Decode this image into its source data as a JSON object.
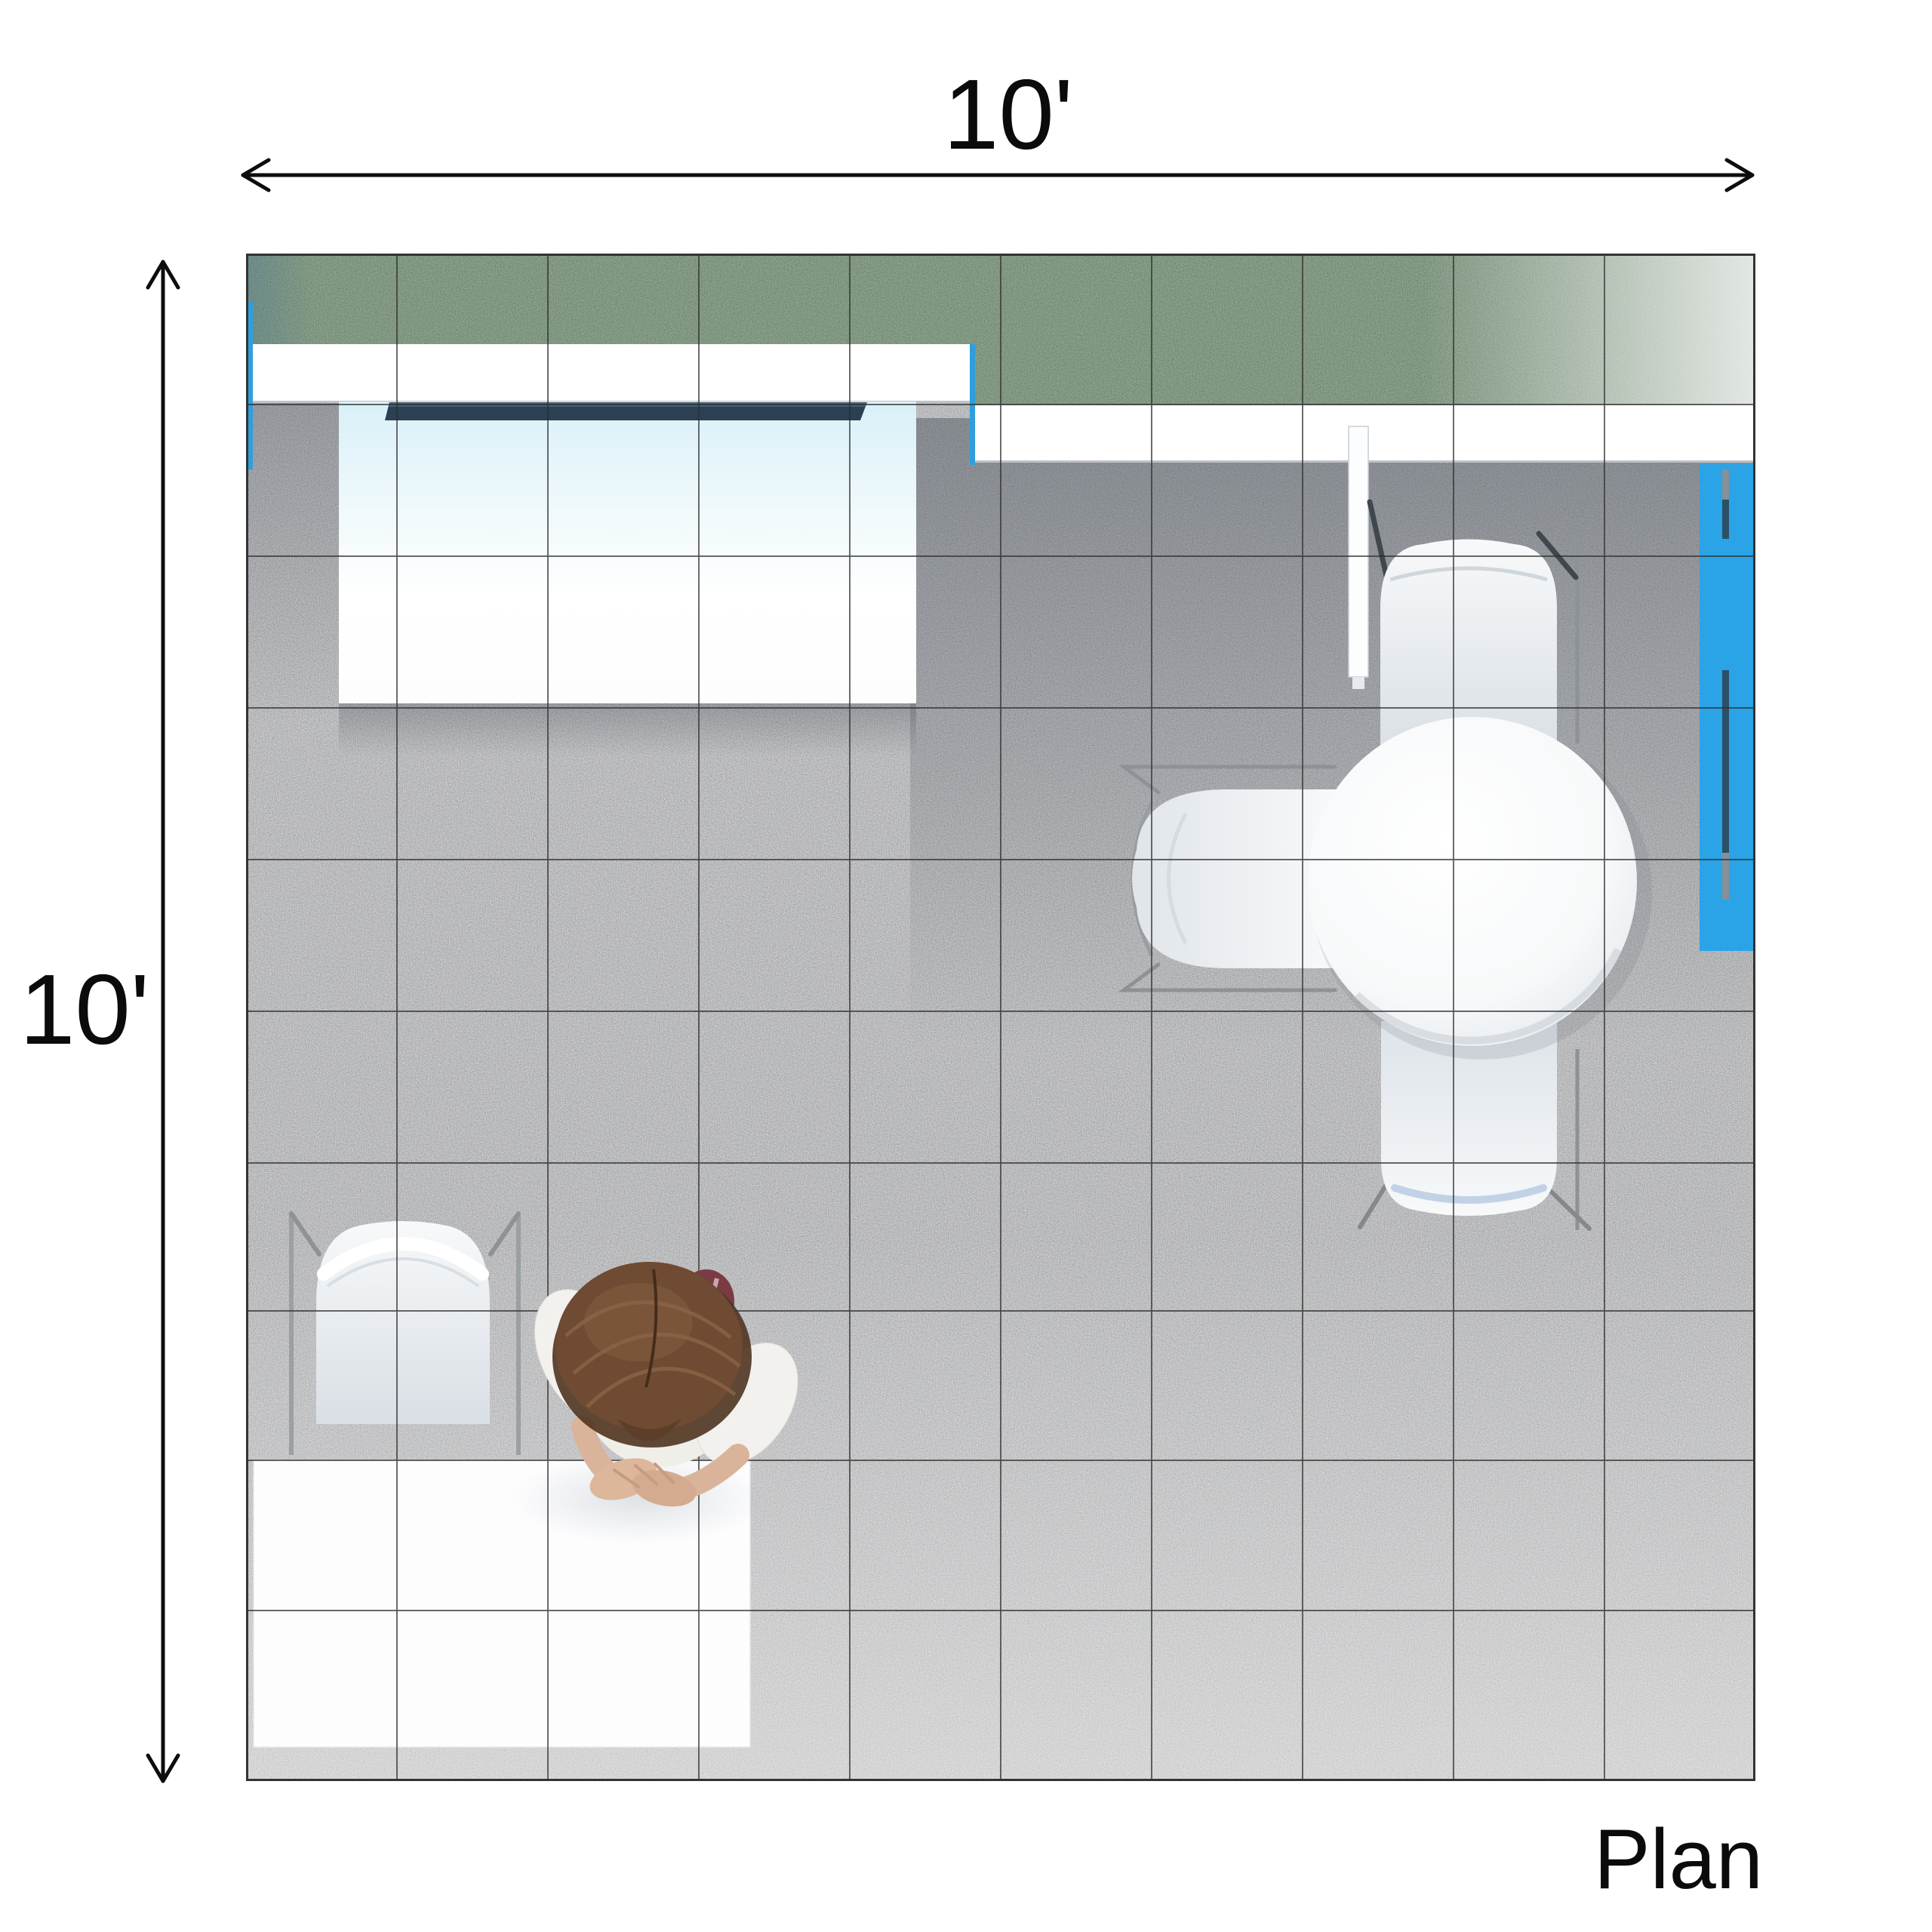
{
  "labels": {
    "width_dimension": "10'",
    "height_dimension": "10'",
    "caption": "Plan"
  },
  "scene": {
    "view": "top-down floor plan of 10 ft x 10 ft exhibit booth",
    "booth_width_label": "10'",
    "booth_depth_label": "10'",
    "grid": {
      "columns": 10,
      "rows": 10
    },
    "objects": [
      "green-carpet-band",
      "overhead-canopy-left",
      "overhead-canopy-right",
      "graphic-header-bar",
      "reception-counter",
      "blue-storage-cabinet",
      "cabinet-door-handles",
      "wall-divider-post",
      "round-meeting-table",
      "guest-chair-top",
      "guest-chair-left",
      "guest-chair-bottom",
      "side-chair",
      "seated-person",
      "white-meeting-table",
      "floor-tiles"
    ]
  },
  "colors": {
    "carpet_green": "#8ba98c",
    "floor_base": "#d7d8da",
    "canopy_white": "#ffffff",
    "counter_tint": "#d9f0f8",
    "header_navy": "#2b4052",
    "cabinet_blue": "#2aa4e6",
    "handle_navy": "#2b5166",
    "handle_gray": "#84909a",
    "accent_blue": "#2f9fdc",
    "frame_gray": "#8d9296",
    "hair_brown": "#6f4b33",
    "chair_maroon": "#7b3b44",
    "skin_tone": "#d9b49a",
    "grid_line": "#2e2e2e",
    "dimension_ink": "#0d0d0d"
  }
}
